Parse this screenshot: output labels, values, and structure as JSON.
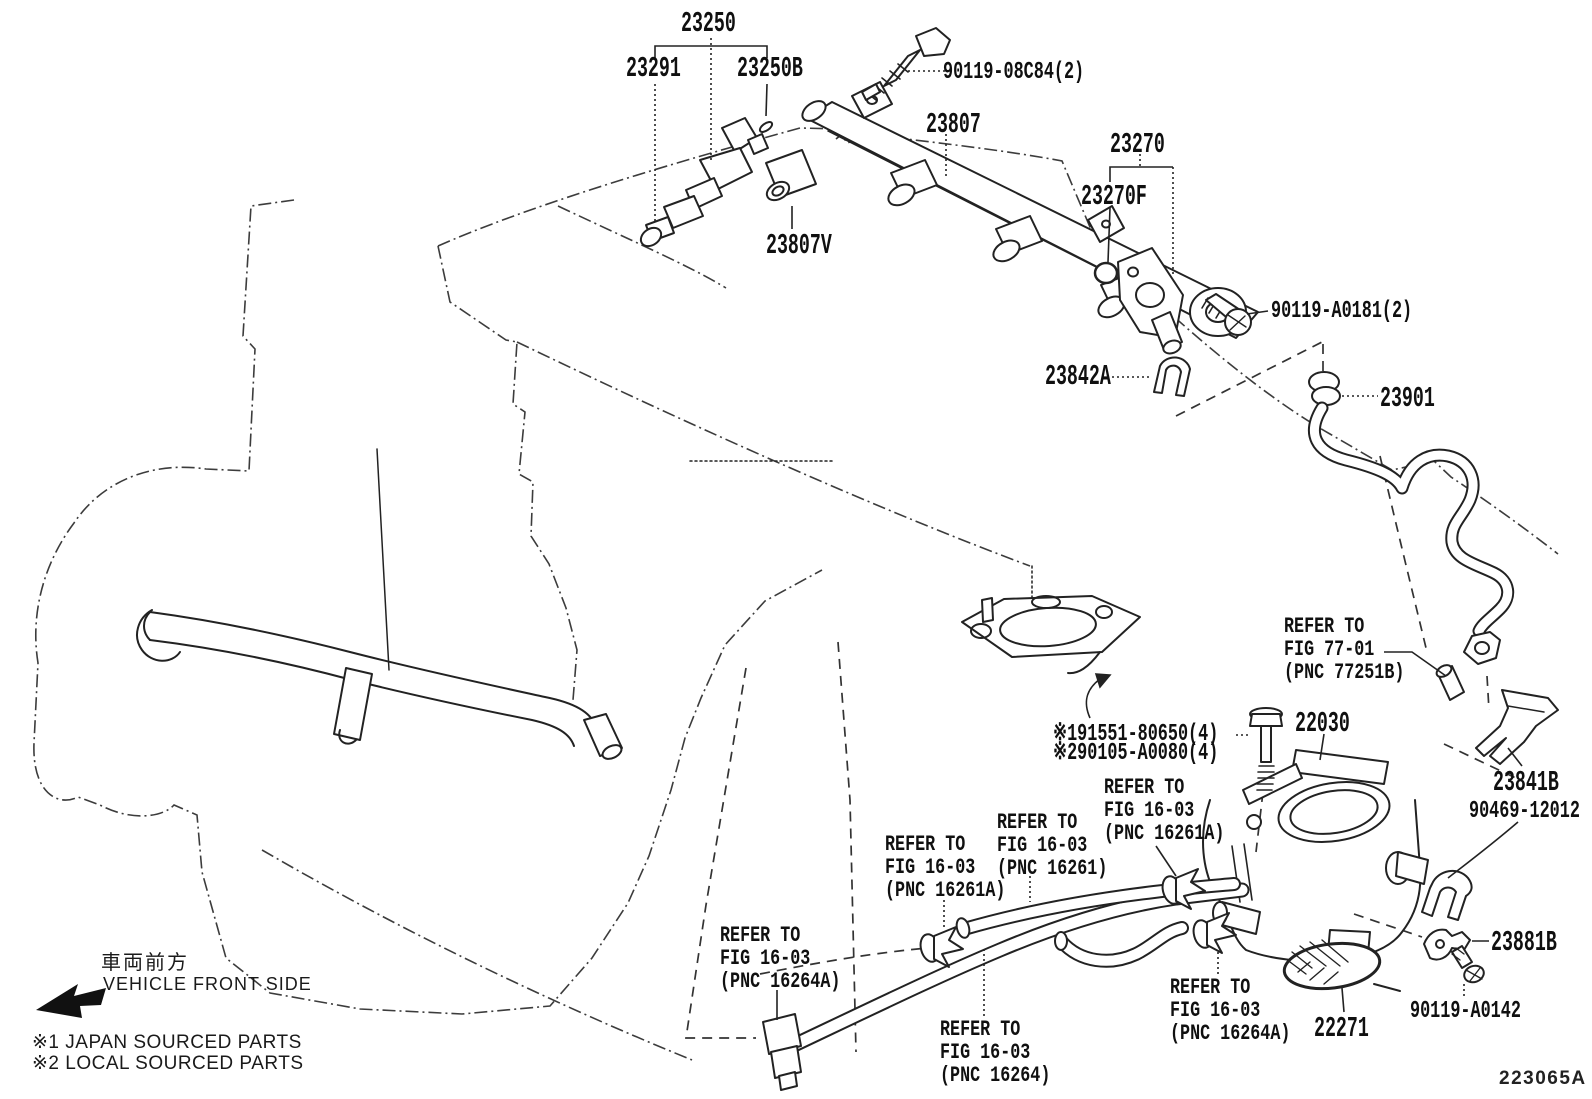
{
  "diagram": {
    "figure_code": "223065A",
    "part_labels": {
      "p23250": "23250",
      "p23291": "23291",
      "p23250b": "23250B",
      "b08c84": "90119-08C84(2)",
      "p23807": "23807",
      "p23807v": "23807V",
      "p23270": "23270",
      "p23270f": "23270F",
      "ba0181": "90119-A0181(2)",
      "p23842a": "23842A",
      "p23901": "23901",
      "p22030": "22030",
      "n1bolt": "※191551-80650(4)",
      "n2bolt": "※290105-A0080(4)",
      "p23841b": "23841B",
      "b90469": "90469-12012",
      "p23881b": "23881B",
      "ba0142": "90119-A0142",
      "p22271": "22271"
    },
    "refer_notes": {
      "r77": {
        "l1": "REFER TO",
        "l2": "FIG 77-01",
        "l3": "(PNC 77251B)"
      },
      "r16261a_r": {
        "l1": "REFER TO",
        "l2": "FIG 16-03",
        "l3": "(PNC 16261A)"
      },
      "r16261": {
        "l1": "REFER TO",
        "l2": "FIG 16-03",
        "l3": "(PNC 16261)"
      },
      "r16261a_l": {
        "l1": "REFER TO",
        "l2": "FIG 16-03",
        "l3": "(PNC 16261A)"
      },
      "r16264a_l": {
        "l1": "REFER TO",
        "l2": "FIG 16-03",
        "l3": "(PNC 16264A)"
      },
      "r16264": {
        "l1": "REFER TO",
        "l2": "FIG 16-03",
        "l3": "(PNC 16264)"
      },
      "r16264a_r": {
        "l1": "REFER TO",
        "l2": "FIG 16-03",
        "l3": "(PNC 16264A)"
      }
    },
    "legend": {
      "front_jp": "車両前方",
      "front_en": "VEHICLE FRONT SIDE",
      "note1": "※1 JAPAN SOURCED PARTS",
      "note2": "※2 LOCAL SOURCED PARTS"
    }
  }
}
